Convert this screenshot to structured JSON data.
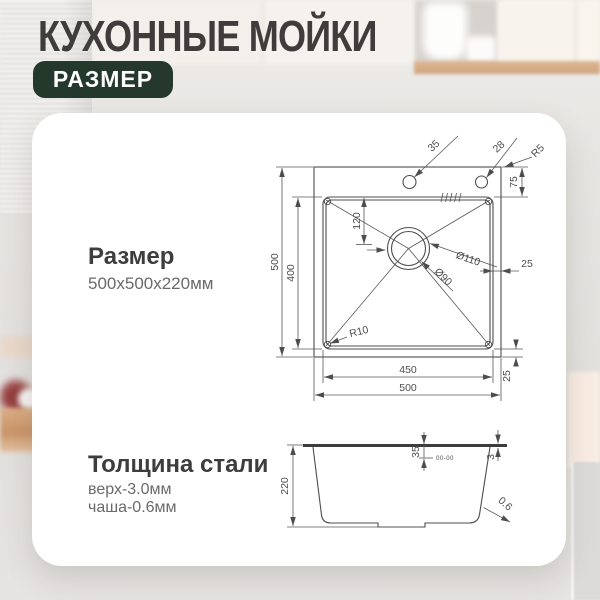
{
  "header": {
    "title": "КУХОННЫЕ МОЙКИ",
    "badge": "РАЗМЕР"
  },
  "card": {
    "size": {
      "label": "Размер",
      "value": "500x500x220мм"
    },
    "thickness": {
      "label": "Толщина стали",
      "line1": "верх-3.0мм",
      "line2": "чаша-0.6мм"
    }
  },
  "drawing": {
    "top_view": {
      "faucet_hole_1": "35",
      "faucet_hole_2": "28",
      "corner_radius": "R5",
      "back_ledge": "75",
      "drain_offset": "120",
      "drain_outer": "Ø110",
      "drain_inner": "Ø90",
      "right_margin": "25",
      "overall_depth": "500",
      "bowl_depth": "400",
      "bowl_corner_radius": "R10",
      "bowl_width": "450",
      "overall_width": "500",
      "bottom_margin": "25"
    },
    "side_view": {
      "height": "220",
      "rim_drop": "35",
      "top_thickness": "3",
      "wall_thickness": "0.6",
      "stamp": "00-00"
    }
  },
  "colors": {
    "badge_green": "#24382c",
    "title_gray": "#3e3d3b",
    "line_gray": "#4d4d4d",
    "subtext_gray": "#6a6a6a"
  }
}
